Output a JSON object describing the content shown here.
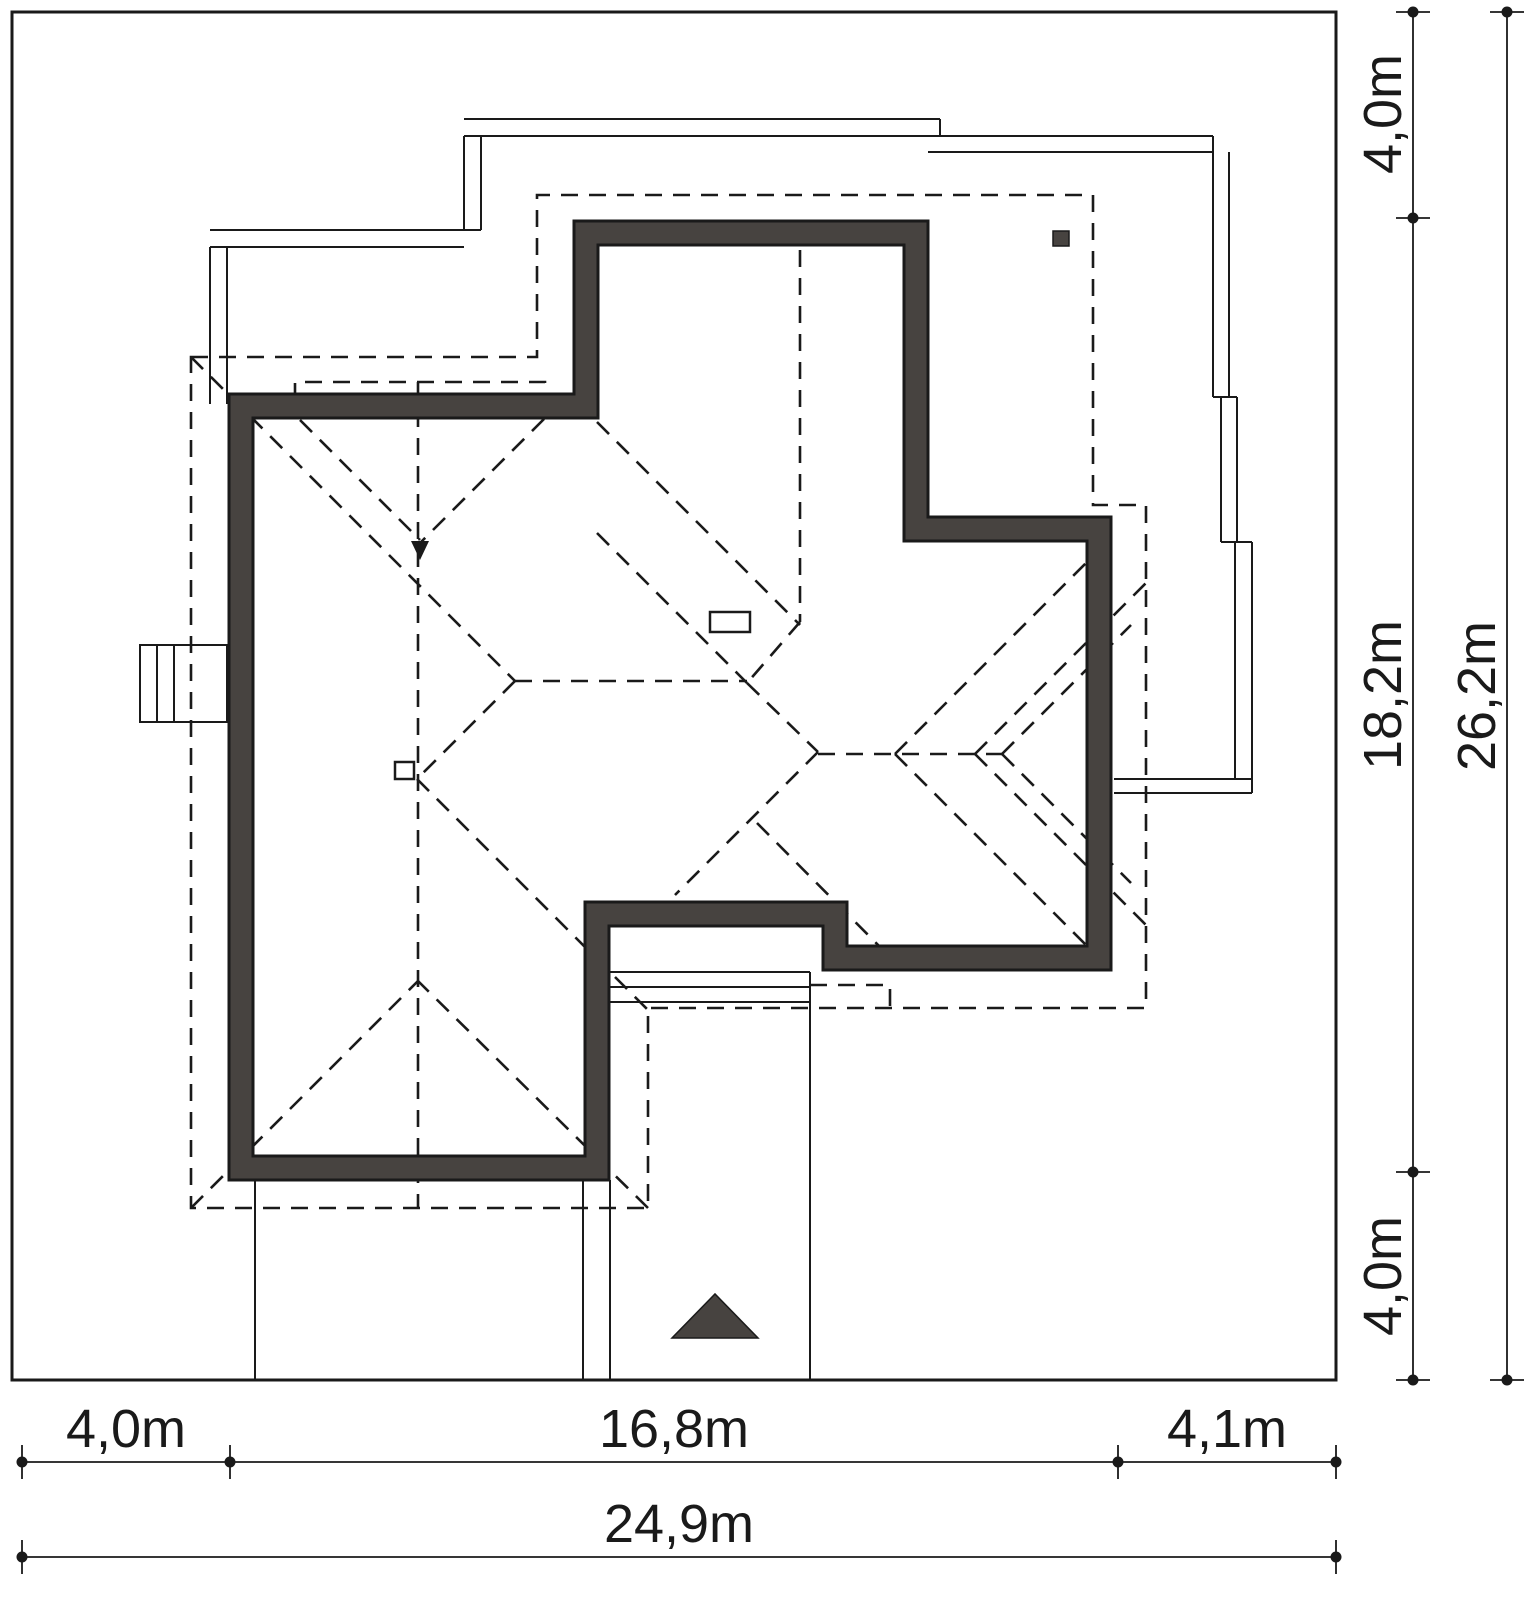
{
  "document": {
    "kind": "architectural-site-plan",
    "view": "roof plan of detached house on plot with setback dimensions",
    "background": "#ffffff"
  },
  "colors": {
    "line": "#1a1a1a",
    "wall_fill": "#474340",
    "background": "#ffffff"
  },
  "plot": {
    "total_width_label": "24,9m",
    "total_height_label": "26,2m"
  },
  "dimensions": {
    "bottom_row1": {
      "segments": [
        {
          "label": "4,0m"
        },
        {
          "label": "16,8m"
        },
        {
          "label": "4,1m"
        }
      ]
    },
    "bottom_row2": {
      "label": "24,9m"
    },
    "right_col1": {
      "segments": [
        {
          "label": "4,0m"
        },
        {
          "label": "18,2m"
        },
        {
          "label": "4,0m"
        }
      ]
    },
    "right_col2": {
      "label": "26,2m"
    }
  }
}
